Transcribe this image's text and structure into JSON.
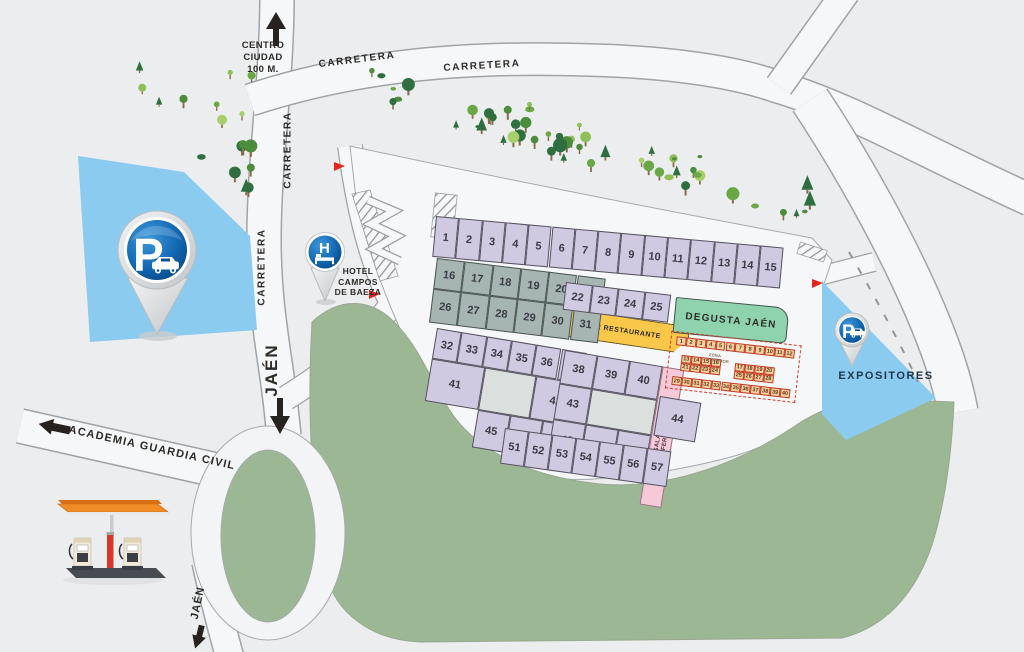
{
  "colors": {
    "background": "#ebedee",
    "road_fill": "#f6f7f8",
    "road_stroke": "#9fa4a7",
    "plateau_fill": "#f6f7f8",
    "green_area": "#9cb793",
    "parking_blue": "#8ccbf0",
    "stand_lavender": "#d0c9e2",
    "stand_gray": "#a6b5b2",
    "bar_yellow": "#f9c84a",
    "degusta_green": "#8fd2ae",
    "sala_pink": "#f6c9d9",
    "mini_stand_fill": "#f5d2a0",
    "mini_stand_border": "#c23b27",
    "pin_blue": "#0a4f90",
    "flag_red": "#e2261d",
    "text_dark": "#2d2b28"
  },
  "labels": {
    "centro_ciudad": [
      "CENTRO",
      "CIUDAD",
      "100 M."
    ],
    "carretera_top_1": "CARRETERA",
    "carretera_top_2": "CARRETERA",
    "carretera_side_1": "CARRETERA",
    "carretera_side_2": "CARRETERA",
    "jaen_mid": "JAÉN",
    "jaen_bottom": "JAÉN",
    "academia_guardia_civil": "ACADEMIA GUARDIA CIVIL",
    "hotel": [
      "HOTEL",
      "CAMPOS",
      "DE BAEZA"
    ],
    "bar_restaurante": "BAR RESTAURANTE",
    "degusta_jaen": "DEGUSTA JAÉN",
    "sala_conferencias": [
      "SALA DE",
      "CONFERENCIAS"
    ],
    "zona_interior": "ZONA INTERIOR",
    "expositores": "EXPOSITORES",
    "parking_letter": "P",
    "hotel_letter": "H"
  },
  "stands": {
    "row_top": [
      "1",
      "2",
      "3",
      "4",
      "5",
      "6",
      "7",
      "8",
      "9",
      "10",
      "11",
      "12",
      "13",
      "14",
      "15"
    ],
    "gray_row1": [
      "16",
      "17",
      "18",
      "19",
      "20",
      "21"
    ],
    "gray_row2": [
      "26",
      "27",
      "28",
      "29",
      "30",
      "31"
    ],
    "row_mid": [
      "22",
      "23",
      "24",
      "25"
    ],
    "left_block_top": [
      "32",
      "33",
      "34",
      "35",
      "36",
      "37"
    ],
    "left_block_big": "41",
    "left_block_right": "42",
    "left_block_bottom": [
      "45",
      "46",
      "47"
    ],
    "right_block_top": [
      "38",
      "39",
      "40"
    ],
    "right_block_mid": "43",
    "right_block_bottom": [
      "48",
      "49",
      "50"
    ],
    "stand_44": "44",
    "row_bottom": [
      "51",
      "52",
      "53",
      "54",
      "55",
      "56",
      "57"
    ]
  },
  "mini_stands": {
    "top_row": [
      "1",
      "2",
      "3",
      "4",
      "5",
      "6",
      "7",
      "8",
      "9",
      "10",
      "11",
      "12"
    ],
    "left_rows": [
      [
        "13",
        "14",
        "15",
        "16"
      ],
      [
        "21",
        "22",
        "23",
        "24"
      ]
    ],
    "right_rows": [
      [
        "17",
        "18",
        "19",
        "20"
      ],
      [
        "25",
        "26",
        "27",
        "28"
      ]
    ],
    "bottom_row": [
      "29",
      "30",
      "31",
      "32",
      "33",
      "34",
      "35",
      "36",
      "37",
      "38",
      "39",
      "40"
    ]
  }
}
